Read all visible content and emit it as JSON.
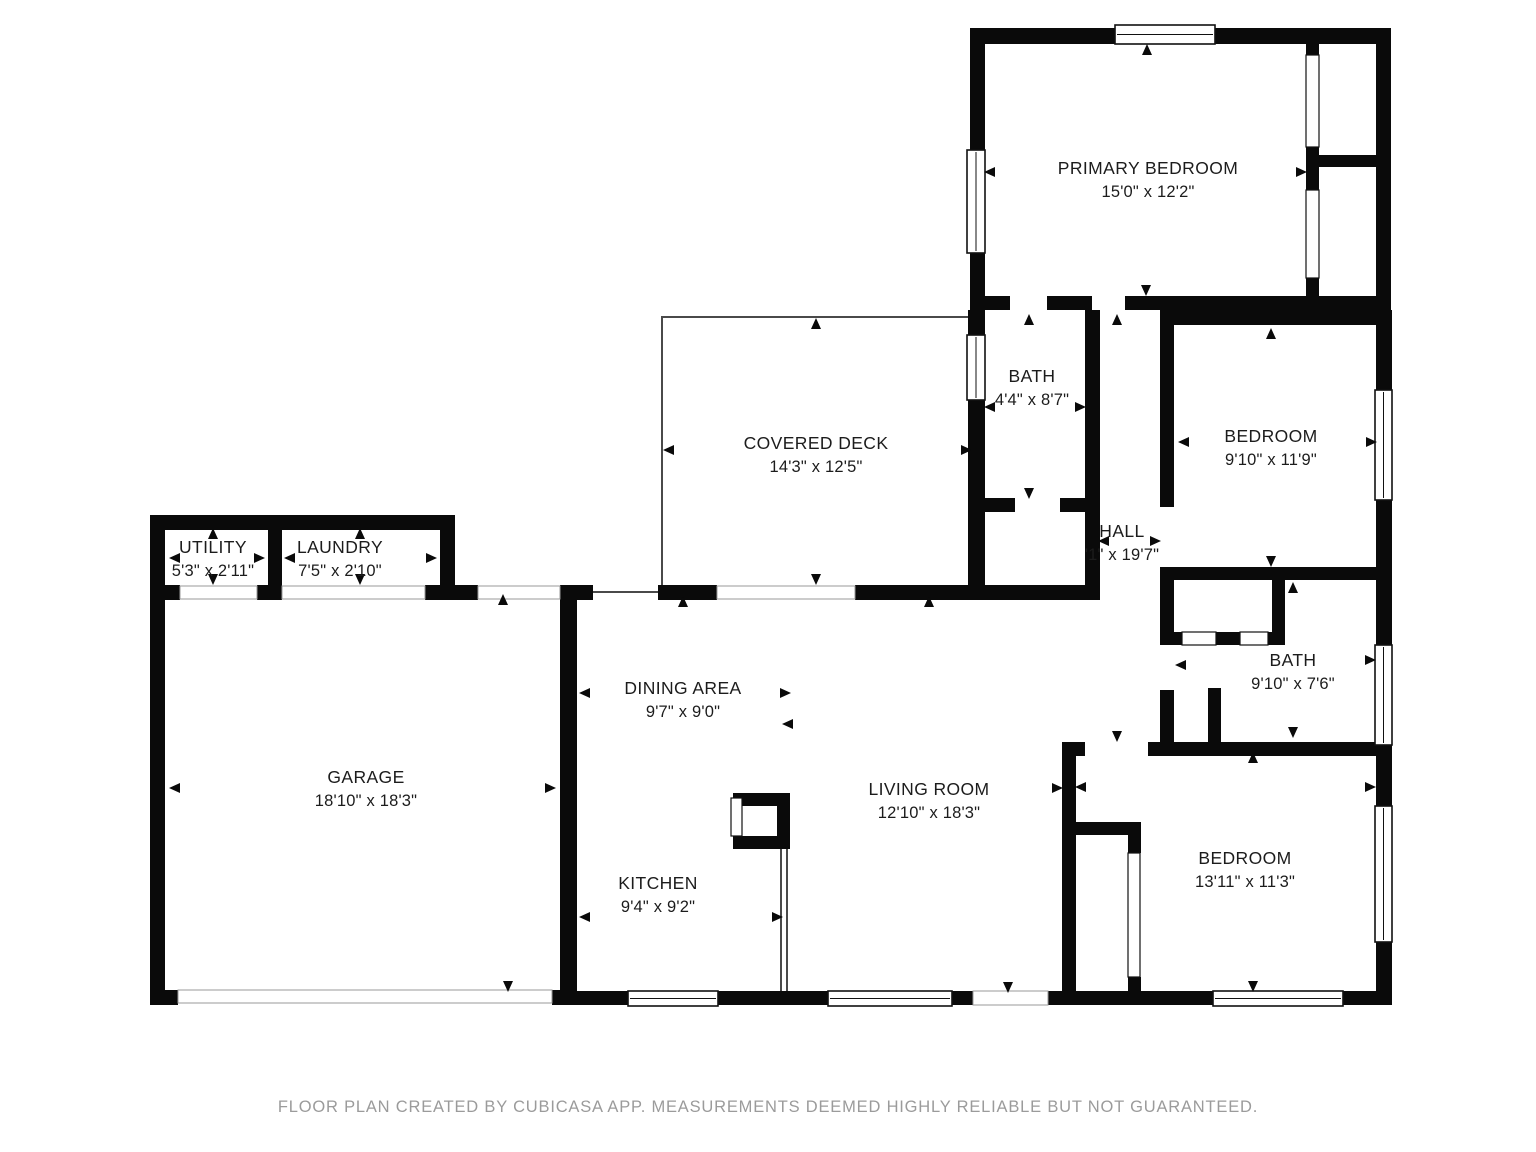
{
  "footer": "FLOOR PLAN CREATED BY CUBICASA APP. MEASUREMENTS DEEMED HIGHLY RELIABLE BUT NOT GUARANTEED.",
  "colors": {
    "wall": "#0a0a0a",
    "background": "#ffffff",
    "thin_line": "#4a4a4a",
    "window_stroke": "#111111",
    "threshold_stroke": "#9a9a9a",
    "label_text": "#1c1c1c",
    "footer_text": "#9b9b9b"
  },
  "rooms": [
    {
      "id": "primary-bedroom",
      "name": "PRIMARY BEDROOM",
      "dims": "15'0\" x 12'2\"",
      "cx": 1148,
      "cy": 180
    },
    {
      "id": "bath-top",
      "name": "BATH",
      "dims": "4'4\" x 8'7\"",
      "cx": 1032,
      "cy": 388
    },
    {
      "id": "hall",
      "name": "HALL",
      "dims": "'1\" x 19'7\"",
      "cx": 1122,
      "cy": 543
    },
    {
      "id": "bedroom-top-right",
      "name": "BEDROOM",
      "dims": "9'10\" x 11'9\"",
      "cx": 1271,
      "cy": 448
    },
    {
      "id": "covered-deck",
      "name": "COVERED DECK",
      "dims": "14'3\" x 12'5\"",
      "cx": 816,
      "cy": 455
    },
    {
      "id": "utility",
      "name": "UTILITY",
      "dims": "5'3\" x 2'11\"",
      "cx": 213,
      "cy": 559
    },
    {
      "id": "laundry",
      "name": "LAUNDRY",
      "dims": "7'5\" x 2'10\"",
      "cx": 340,
      "cy": 559
    },
    {
      "id": "garage",
      "name": "GARAGE",
      "dims": "18'10\" x 18'3\"",
      "cx": 366,
      "cy": 789
    },
    {
      "id": "dining-area",
      "name": "DINING AREA",
      "dims": "9'7\" x 9'0\"",
      "cx": 683,
      "cy": 700
    },
    {
      "id": "kitchen",
      "name": "KITCHEN",
      "dims": "9'4\" x 9'2\"",
      "cx": 658,
      "cy": 895
    },
    {
      "id": "living-room",
      "name": "LIVING ROOM",
      "dims": "12'10\" x 18'3\"",
      "cx": 929,
      "cy": 801
    },
    {
      "id": "bath-right",
      "name": "BATH",
      "dims": "9'10\" x 7'6\"",
      "cx": 1293,
      "cy": 672
    },
    {
      "id": "bedroom-bottom-right",
      "name": "BEDROOM",
      "dims": "13'11\" x 11'3\"",
      "cx": 1245,
      "cy": 870
    }
  ],
  "geometry": {
    "walls": [
      [
        970,
        28,
        421,
        16
      ],
      [
        970,
        44,
        15,
        266
      ],
      [
        1376,
        44,
        15,
        266
      ],
      [
        970,
        296,
        40,
        14
      ],
      [
        1047,
        296,
        45,
        14
      ],
      [
        1125,
        296,
        266,
        14
      ],
      [
        1306,
        44,
        13,
        11
      ],
      [
        1306,
        147,
        13,
        43
      ],
      [
        1306,
        278,
        13,
        18
      ],
      [
        1319,
        155,
        57,
        12
      ],
      [
        1376,
        310,
        16,
        80
      ],
      [
        1376,
        500,
        16,
        145
      ],
      [
        1376,
        745,
        16,
        61
      ],
      [
        1376,
        942,
        16,
        63
      ],
      [
        968,
        310,
        17,
        25
      ],
      [
        968,
        400,
        17,
        195
      ],
      [
        1085,
        310,
        15,
        290
      ],
      [
        1160,
        310,
        14,
        197
      ],
      [
        1160,
        567,
        14,
        78
      ],
      [
        1160,
        690,
        14,
        62
      ],
      [
        1174,
        310,
        217,
        15
      ],
      [
        1160,
        567,
        231,
        13
      ],
      [
        1174,
        632,
        8,
        13
      ],
      [
        1216,
        632,
        24,
        13
      ],
      [
        1268,
        632,
        17,
        13
      ],
      [
        1272,
        580,
        13,
        52
      ],
      [
        1208,
        688,
        13,
        64
      ],
      [
        1062,
        742,
        23,
        14
      ],
      [
        1148,
        742,
        243,
        14
      ],
      [
        1062,
        742,
        14,
        263
      ],
      [
        1076,
        822,
        65,
        13
      ],
      [
        1128,
        822,
        13,
        31
      ],
      [
        1128,
        977,
        13,
        28
      ],
      [
        855,
        585,
        230,
        15
      ],
      [
        985,
        498,
        30,
        14
      ],
      [
        1060,
        498,
        25,
        14
      ],
      [
        658,
        585,
        59,
        15
      ],
      [
        150,
        585,
        30,
        15
      ],
      [
        257,
        585,
        25,
        15
      ],
      [
        425,
        585,
        53,
        15
      ],
      [
        560,
        585,
        33,
        15
      ],
      [
        150,
        515,
        305,
        15
      ],
      [
        268,
        530,
        14,
        55
      ],
      [
        440,
        515,
        15,
        70
      ],
      [
        150,
        515,
        15,
        490
      ],
      [
        560,
        593,
        17,
        412
      ],
      [
        150,
        990,
        28,
        15
      ],
      [
        552,
        990,
        25,
        15
      ],
      [
        577,
        991,
        51,
        14
      ],
      [
        718,
        991,
        110,
        14
      ],
      [
        952,
        991,
        21,
        14
      ],
      [
        1048,
        991,
        28,
        14
      ],
      [
        1076,
        991,
        137,
        14
      ],
      [
        1343,
        991,
        48,
        14
      ],
      [
        733,
        793,
        57,
        13
      ],
      [
        777,
        793,
        13,
        55
      ],
      [
        733,
        836,
        57,
        13
      ]
    ],
    "windows": [
      [
        1115,
        25,
        100,
        19,
        "h"
      ],
      [
        967,
        150,
        18,
        103,
        "v"
      ],
      [
        967,
        335,
        18,
        65,
        "v"
      ],
      [
        1375,
        390,
        17,
        110,
        "v"
      ],
      [
        1375,
        645,
        17,
        100,
        "v"
      ],
      [
        1375,
        806,
        17,
        136,
        "v"
      ],
      [
        1213,
        991,
        130,
        15,
        "h"
      ],
      [
        828,
        991,
        124,
        15,
        "h"
      ],
      [
        628,
        991,
        90,
        15,
        "h"
      ]
    ],
    "door_panels": [
      [
        1306,
        55,
        13,
        92
      ],
      [
        1306,
        190,
        13,
        88
      ],
      [
        1182,
        632,
        34,
        13
      ],
      [
        1240,
        632,
        28,
        13
      ],
      [
        1128,
        853,
        12,
        124
      ],
      [
        731,
        798,
        11,
        38
      ]
    ],
    "thresholds": [
      [
        180,
        586,
        77,
        13
      ],
      [
        282,
        586,
        143,
        13
      ],
      [
        478,
        586,
        82,
        13
      ],
      [
        717,
        586,
        138,
        13
      ],
      [
        178,
        990,
        374,
        13
      ],
      [
        973,
        991,
        75,
        14
      ]
    ],
    "thin_polylines": [
      [
        [
          662,
          592
        ],
        [
          662,
          317
        ],
        [
          973,
          317
        ]
      ],
      [
        [
          593,
          592
        ],
        [
          658,
          592
        ]
      ],
      [
        [
          781,
          849
        ],
        [
          781,
          991
        ]
      ],
      [
        [
          787,
          849
        ],
        [
          787,
          991
        ]
      ]
    ],
    "arrows": [
      [
        990,
        172,
        "left"
      ],
      [
        1301,
        172,
        "right"
      ],
      [
        1147,
        50,
        "up"
      ],
      [
        1146,
        290,
        "down"
      ],
      [
        990,
        407,
        "left"
      ],
      [
        1080,
        407,
        "right"
      ],
      [
        1029,
        320,
        "up"
      ],
      [
        1029,
        493,
        "down"
      ],
      [
        1104,
        541,
        "left"
      ],
      [
        1155,
        541,
        "right"
      ],
      [
        1117,
        320,
        "up"
      ],
      [
        1117,
        736,
        "down"
      ],
      [
        1184,
        442,
        "left"
      ],
      [
        1371,
        442,
        "right"
      ],
      [
        1271,
        334,
        "up"
      ],
      [
        1271,
        561,
        "down"
      ],
      [
        669,
        450,
        "left"
      ],
      [
        966,
        450,
        "right"
      ],
      [
        816,
        324,
        "up"
      ],
      [
        816,
        579,
        "down"
      ],
      [
        175,
        558,
        "left"
      ],
      [
        259,
        558,
        "right"
      ],
      [
        213,
        534,
        "up"
      ],
      [
        213,
        579,
        "down"
      ],
      [
        290,
        558,
        "left"
      ],
      [
        431,
        558,
        "right"
      ],
      [
        360,
        534,
        "up"
      ],
      [
        360,
        579,
        "down"
      ],
      [
        175,
        788,
        "left"
      ],
      [
        550,
        788,
        "right"
      ],
      [
        503,
        600,
        "up"
      ],
      [
        508,
        986,
        "down"
      ],
      [
        585,
        693,
        "left"
      ],
      [
        785,
        693,
        "right"
      ],
      [
        683,
        602,
        "up"
      ],
      [
        788,
        724,
        "left"
      ],
      [
        585,
        917,
        "left"
      ],
      [
        777,
        917,
        "right"
      ],
      [
        1057,
        788,
        "right"
      ],
      [
        929,
        602,
        "up"
      ],
      [
        1008,
        987,
        "down"
      ],
      [
        1181,
        665,
        "left"
      ],
      [
        1370,
        660,
        "right"
      ],
      [
        1293,
        588,
        "up"
      ],
      [
        1293,
        732,
        "down"
      ],
      [
        1081,
        787,
        "left"
      ],
      [
        1370,
        787,
        "right"
      ],
      [
        1253,
        758,
        "up"
      ],
      [
        1253,
        986,
        "down"
      ]
    ]
  }
}
